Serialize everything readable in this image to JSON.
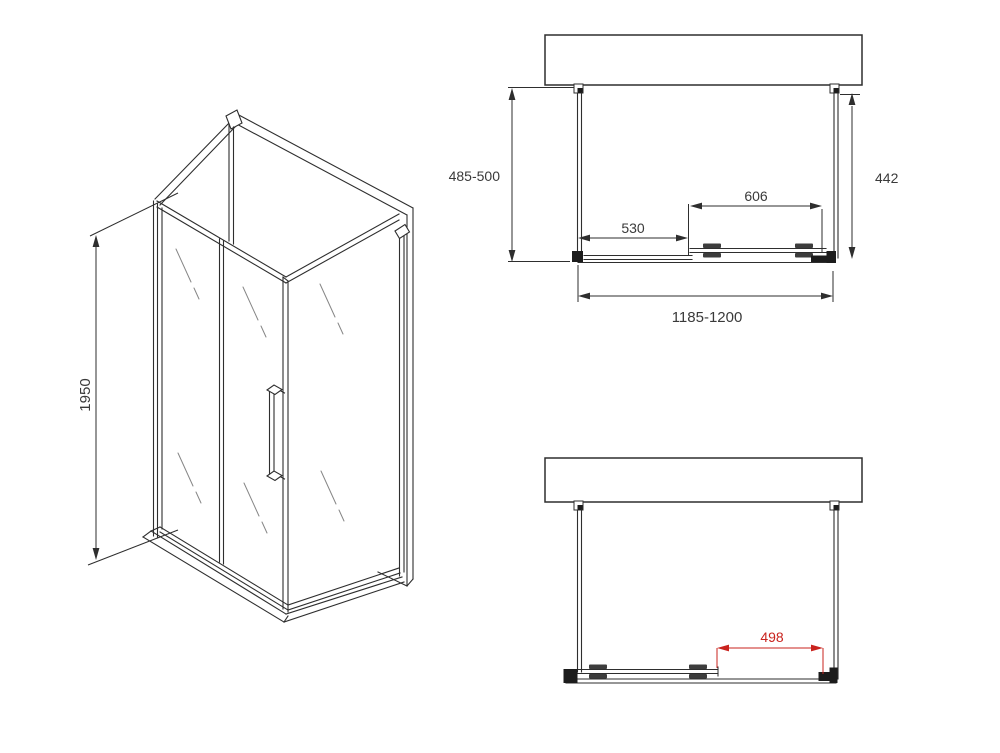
{
  "colors": {
    "line-color": "#2e2e2e",
    "dim-text-color": "#3a3a3a",
    "accent-color": "#c9231e",
    "background": "#ffffff"
  },
  "isometric_view": {
    "height_dim": "1950"
  },
  "top_view": {
    "depth_left_dim": "485-500",
    "depth_right_dim": "442",
    "fixed_segment_dim": "530",
    "door_segment_dim": "606",
    "overall_width_dim": "1185-1200"
  },
  "bottom_view": {
    "opening_dim": "498"
  }
}
